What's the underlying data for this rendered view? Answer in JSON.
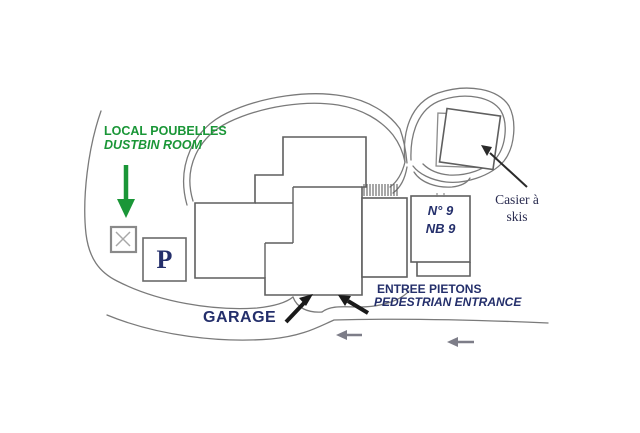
{
  "map": {
    "title_context": "hand-drawn site access plan",
    "labels": {
      "dustbin_fr": "LOCAL POUBELLES",
      "dustbin_en": "DUSTBIN ROOM",
      "parking": "P",
      "building_no_line1": "N° 9",
      "building_no_line2": "NB 9",
      "ski_locker_line1": "Casier à",
      "ski_locker_line2": "skis",
      "garage": "GARAGE",
      "entrance_fr": "ENTREE PIETONS",
      "entrance_en": "PEDESTRIAN ENTRANCE"
    },
    "icons": {
      "dustbin_arrow": "arrow-down-green",
      "garage_arrow": "arrow-up-right-black",
      "entrance_arrow": "arrow-up-left-black",
      "ski_locker_arrow": "arrow-up-left-black",
      "road_direction_arrow_1": "arrow-left-gray",
      "road_direction_arrow_2": "arrow-left-gray",
      "dustbin_room_marker": "x-cross"
    },
    "colors": {
      "accent_green": "#1a9637",
      "ink_navy": "#242f6b",
      "ink_serif_dark": "#2a2c50",
      "sketch_line": "#6e6e6e",
      "building_line": "#5f5f5f",
      "gray_arrow": "#7d7d88",
      "black_arrow": "#1a1a1a",
      "background": "#ffffff"
    }
  }
}
